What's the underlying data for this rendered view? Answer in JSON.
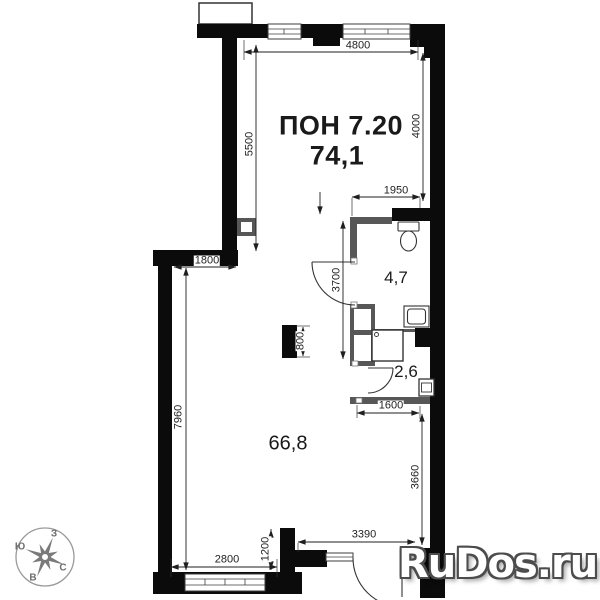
{
  "plan": {
    "unit_label": "ПОН 7.20",
    "total_area": "74,1",
    "rooms": {
      "main_area": "66,8",
      "wc_area": "4,7",
      "shower_area": "2,6"
    },
    "dims": {
      "top": "4800",
      "left_upper": "5500",
      "right_upper": "4000",
      "wc_top": "1950",
      "ledge": "1800",
      "wc_side": "3700",
      "left_lower": "7960",
      "column": "800",
      "shower_bottom": "1600",
      "right_lower": "3660",
      "entry": "3390",
      "notch": "1200",
      "bottom": "2800"
    },
    "compass": {
      "top": "З",
      "left": "Ю",
      "right": "С",
      "bottom": "В"
    }
  },
  "page": {
    "watermark": "RuDos.ru"
  }
}
